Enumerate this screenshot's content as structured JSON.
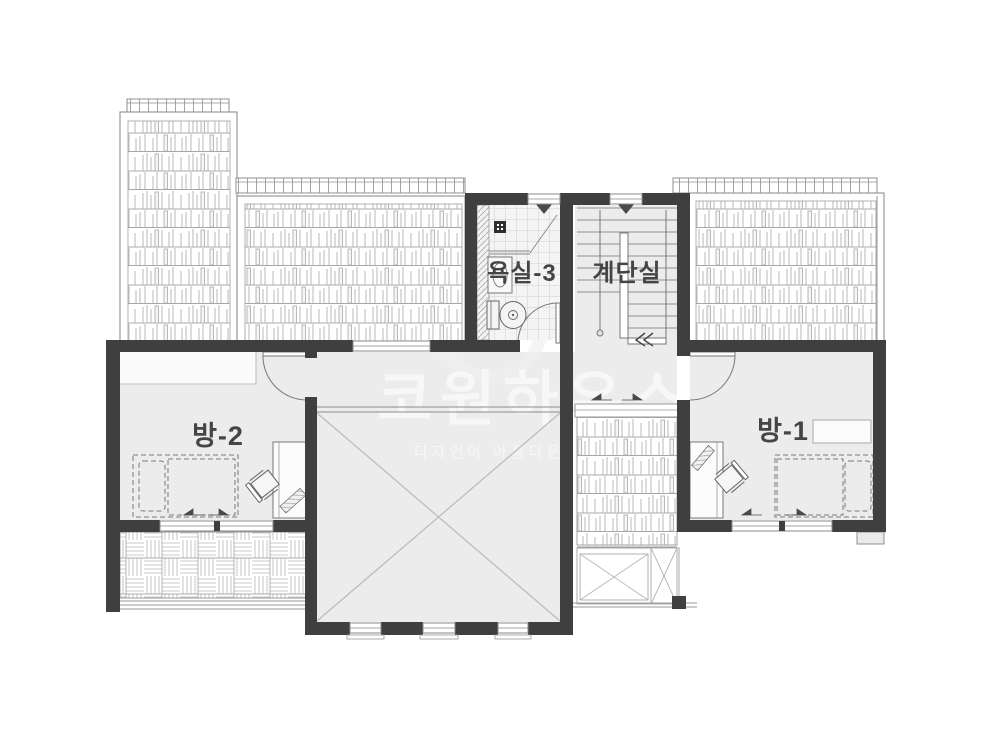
{
  "plan": {
    "rooms": [
      {
        "id": "bathroom",
        "label": "욕실-3"
      },
      {
        "id": "staircase",
        "label": "계단실"
      },
      {
        "id": "room2",
        "label": "방-2"
      },
      {
        "id": "room1",
        "label": "방-1"
      }
    ],
    "watermark": {
      "brand": "코원하우스",
      "tagline": "디자인이 아름다운 집"
    },
    "colors": {
      "wall": "#3f3f3f",
      "floor": "#ececec",
      "label": "#454545",
      "watermark": "#ffffff"
    }
  }
}
